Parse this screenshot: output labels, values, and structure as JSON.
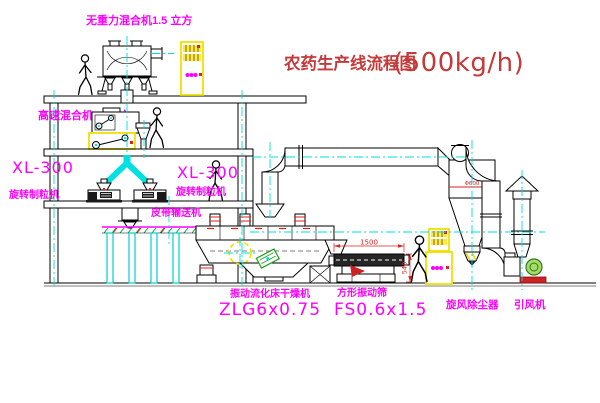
{
  "title": {
    "name_cn": "农药生产线流程图",
    "capacity": "(500kg/h)"
  },
  "labels": {
    "gravity_free_mixer": "无重力混合机1.5 立方",
    "high_speed_mixer": "高速混合机3.5立方",
    "granulator_left_model": "XL-300",
    "granulator_left_name": "旋转制粒机",
    "granulator_mid_model": "XL-300",
    "granulator_mid_name": "旋转制粒机",
    "belt_conveyor": "皮带输送机",
    "fluid_bed_dryer_name": "振动流化床干燥机",
    "fluid_bed_dryer_model": "ZLG6x0.75",
    "square_vibrating_screen_name": "方形振动筛",
    "square_vibrating_screen_model": "FS0.6x1.5",
    "cyclone_dust_collector": "旋风除尘器",
    "induced_draft_fan": "引风机"
  },
  "dimensions": {
    "screen_length": "1500",
    "screen_height": "540",
    "cyclone_note": "Φ600"
  },
  "colors": {
    "label_magenta": "#ff00ff",
    "title_red": "#c43a3a",
    "dimension_red": "#dd2222",
    "highlight_yellow": "#f0e000",
    "centerline_cyan": "#00dede",
    "machine_green": "#18a018",
    "line_black": "#000000",
    "background": "#ffffff"
  }
}
